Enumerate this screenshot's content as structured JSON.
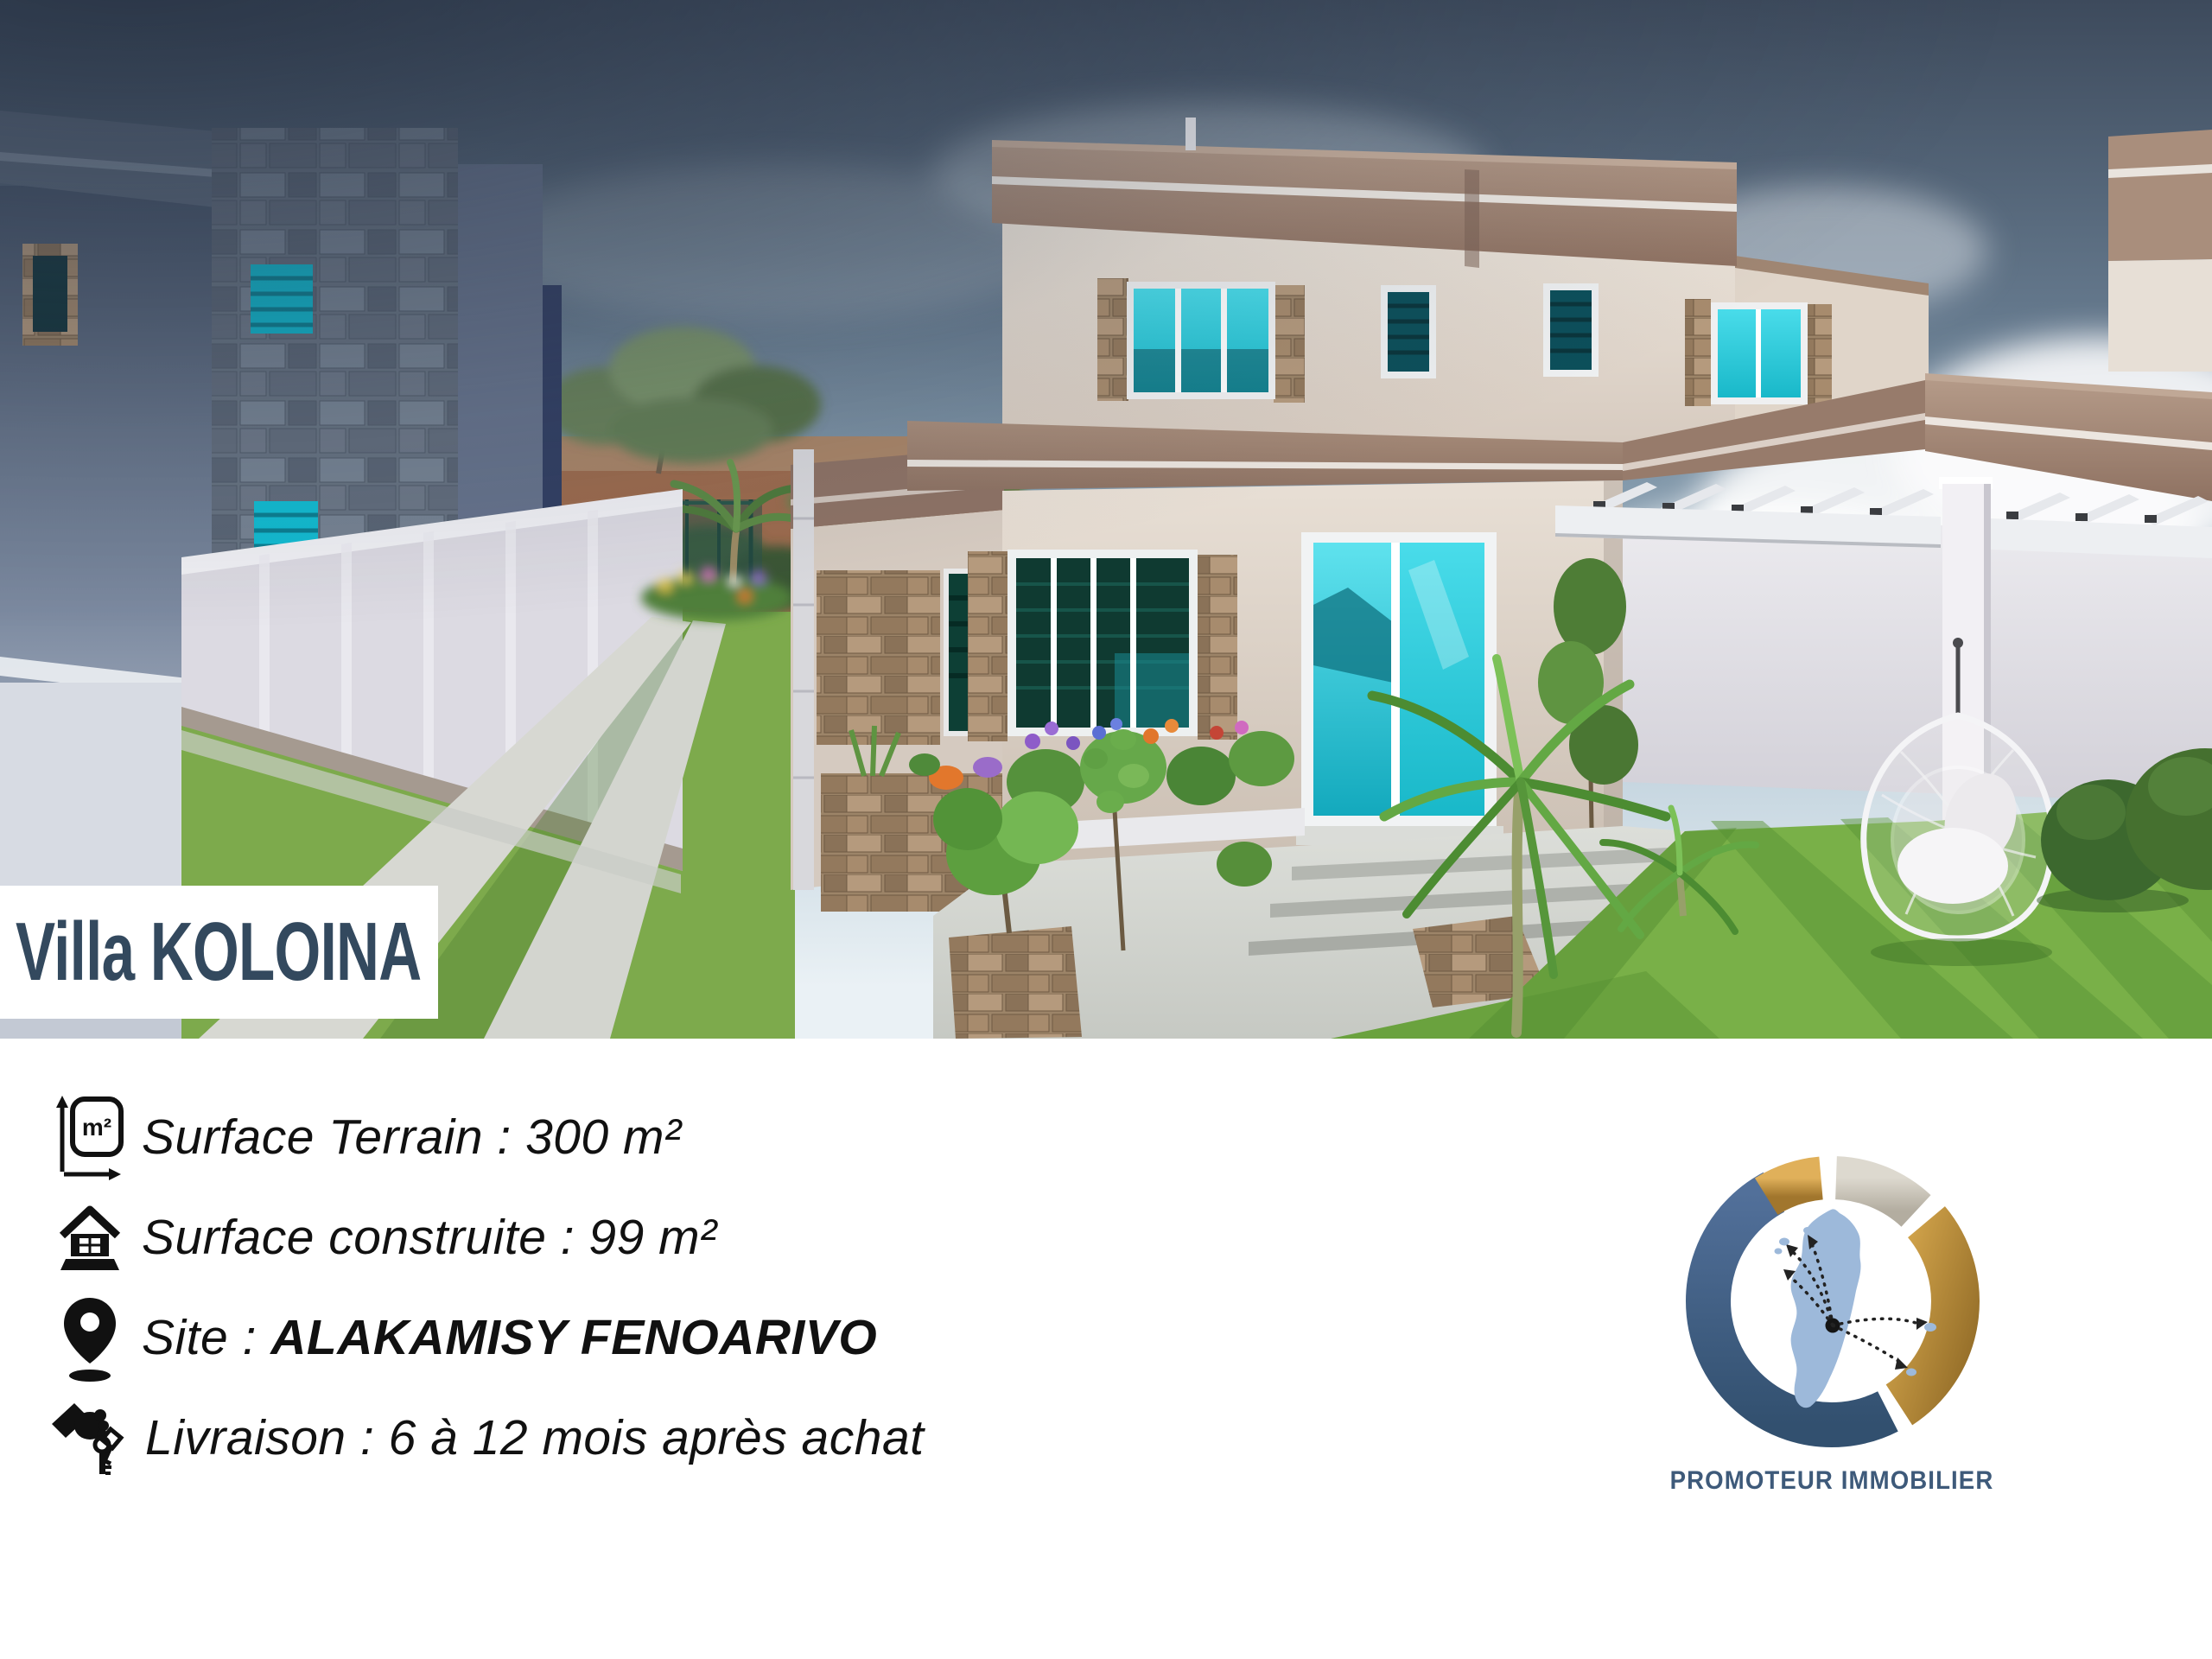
{
  "title": {
    "text": "Villa KOLOINA"
  },
  "ui": {
    "separator": " : "
  },
  "details": [
    {
      "icon": "area-icon",
      "label": "Surface Terrain",
      "value": "300 m²"
    },
    {
      "icon": "house-icon",
      "label": "Surface construite",
      "value": "99 m²"
    },
    {
      "icon": "location-pin-icon",
      "label": "Site",
      "value": "ALAKAMISY FENOARIVO"
    },
    {
      "icon": "key-handover-icon",
      "label": "Livraison",
      "value": "6 à 12 mois après achat"
    }
  ],
  "icons": {
    "area_label": "m²"
  },
  "logo": {
    "caption": "PROMOTEUR IMMOBILIER"
  },
  "colors": {
    "page_bg": "#ffffff",
    "banner_bg": "#ffffff",
    "title_color": "#33495e",
    "body_text": "#111111",
    "logo_text": "#3e5a7a",
    "teal_glass": "#2fd3e0",
    "fascia_brown": "#a08573",
    "cream_wall": "#e8e0d6",
    "grass_green": "#74ad45",
    "logo_blue": "#41597a",
    "logo_gold": "#c8963e",
    "logo_silver": "#cfc9bd",
    "madagascar_blue": "#9db9da"
  }
}
